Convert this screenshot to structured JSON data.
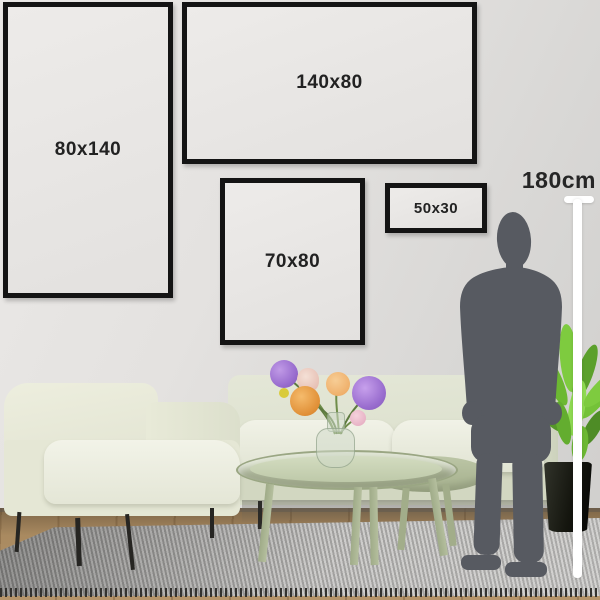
{
  "size_guide": {
    "title": "wall art size comparison",
    "frames": [
      {
        "id": "frame-80x140",
        "label": "80x140"
      },
      {
        "id": "frame-140x80",
        "label": "140x80"
      },
      {
        "id": "frame-70x80",
        "label": "70x80"
      },
      {
        "id": "frame-50x30",
        "label": "50x30"
      }
    ],
    "height_marker": {
      "label": "180cm"
    }
  },
  "scene": {
    "items": [
      "armchair",
      "sofa",
      "nesting-coffee-tables",
      "glass-vase-with-flowers",
      "potted-plant",
      "woven-rug",
      "wood-floor",
      "person-silhouette",
      "measuring-line"
    ]
  },
  "colors": {
    "frame_border": "#141414",
    "label_text": "#222222",
    "silhouette": "#575a61",
    "measure_line": "#ffffff",
    "sofa": "#dfe3d1",
    "armchair": "#ebecdb",
    "table": "#aeb996",
    "plant_green": "#6cb832",
    "pot": "#15160f",
    "rug_gray": "#9a9997",
    "floor_wood": "#a98a60",
    "wall": "#e4e2e0"
  }
}
